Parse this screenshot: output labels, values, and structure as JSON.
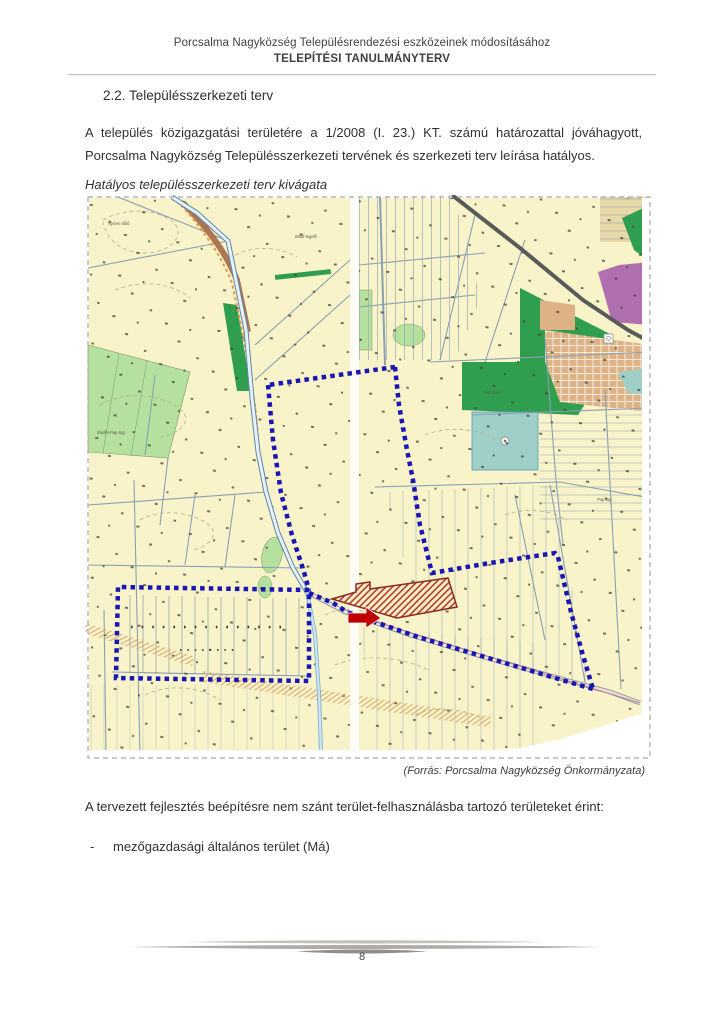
{
  "doc": {
    "header_line1": "Porcsalma Nagyközség Településrendezési eszközeinek módosításához",
    "header_line2": "TELEPÍTÉSI TANULMÁNYTERV",
    "section_heading": "2.2. Településszerkezeti terv",
    "paragraph1": "A település közigazgatási területére a 1/2008 (I. 23.) KT.  számú határozattal jóváhagyott, Porcsalma Nagyközség Településszerkezeti tervének és szerkezeti terv leírása hatályos.",
    "map_caption": "Hatályos településszerkezeti terv kivágata",
    "map_source": "(Forrás: Porcsalma Nagyközség Önkormányzata)",
    "paragraph2": "A tervezett fejlesztés beépítésre nem szánt terület-felhasználásba tartozó területeket érint:",
    "bullet_marker": "-",
    "bullet_text": "mezőgazdasági általános terület (Má)",
    "page_number": "8"
  },
  "map": {
    "labels": [
      {
        "text": "Nyíres-dűlő"
      },
      {
        "text": "Boldi-legelő"
      },
      {
        "text": "Badlói-Pap-tag"
      },
      {
        "text": "Pap-tava"
      },
      {
        "text": "Pap-tag"
      }
    ],
    "colors": {
      "background": "#f8f3c9",
      "boundary_dotted": "#1a16b4",
      "development_hatch": "#b03228",
      "arrow": "#c00000",
      "forest_dark_green": "#2f9e4e",
      "meadow_light_green": "#b5e09d",
      "water_teal": "#9ed0c8",
      "special_purple": "#b070b0",
      "builtup_tan": "#ddb285"
    }
  }
}
